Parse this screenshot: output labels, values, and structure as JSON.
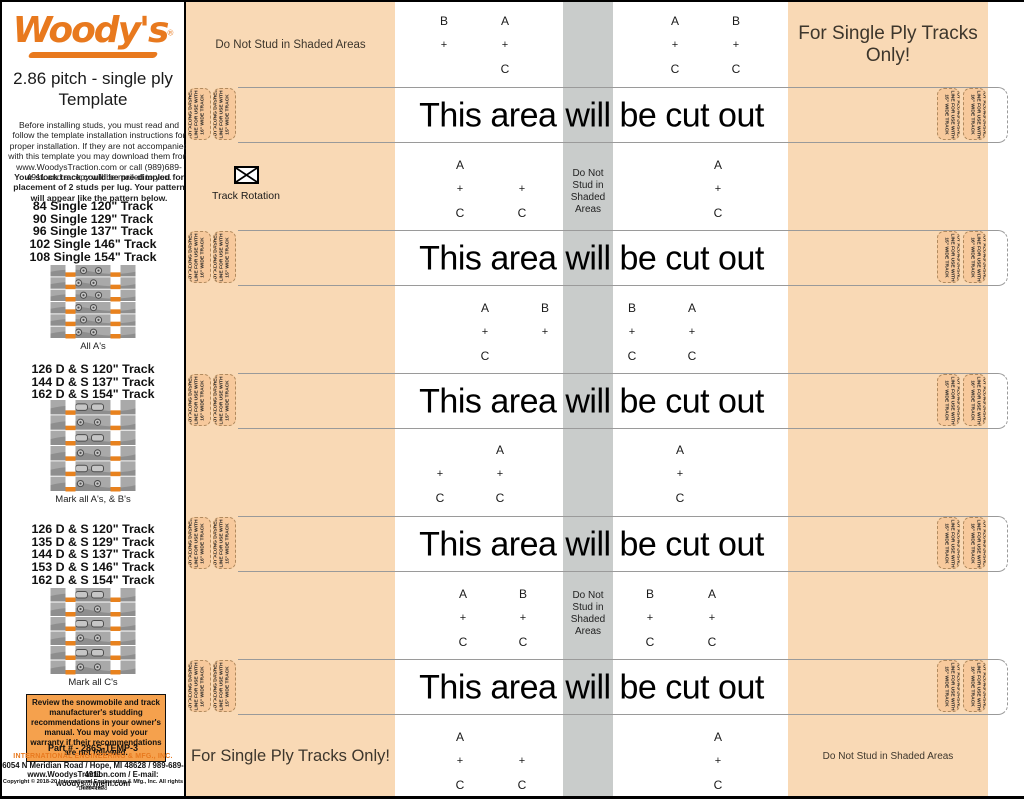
{
  "sidebar": {
    "logo": "Woody's",
    "logo_reg": "®",
    "title_line1": "2.86 pitch - single ply",
    "title_line2": "Template",
    "intro": "Before installing studs, you must read and follow the template installation instructions for proper installation. If they are not accompanied with this template you may download them from www.WoodysTraction.com or call (989)689-4911 and a copy will be mailed to you.",
    "dimple_note": "Your stock track could be pre-dimpled for placement of 2 studs per lug. Your pattern will appear like the pattern below.",
    "track_groups": [
      {
        "lines": [
          "84 Single 120\" Track",
          "90 Single 129\" Track",
          "96 Single 137\" Track",
          "102 Single 146\" Track",
          "108 Single 154\" Track"
        ],
        "caption": "All A's"
      },
      {
        "lines": [
          "126 D & S 120\" Track",
          "144 D & S 137\" Track",
          "162 D & S 154\" Track"
        ],
        "caption": "Mark all A's, & B's"
      },
      {
        "lines": [
          "126 D & S 120\" Track",
          "135 D & S 129\" Track",
          "144 D & S 137\" Track",
          "153 D & S 146\" Track",
          "162 D & S 154\" Track"
        ],
        "caption": "Mark all C's"
      }
    ],
    "warning": "Review the snowmobile and track manufacturer's studding recommendations in your owner's manual. You may void your warranty if their recommendations are not followed.",
    "footer": {
      "part": "Part # - 286S-TEMP-3",
      "company": "INTERNATIONAL ENGINEERING & MFG., INC.",
      "address": "6054 N Meridian Road / Hope, MI 48628 / 989-689-4911",
      "web_email": "www.WoodysTraction.com / E-mail: woodys@wiem.com",
      "copyright": "Copyright © 2018-20 International Engineering & Mfg., Inc. All rights reserved.",
      "doc": "Doc041828"
    }
  },
  "template": {
    "cut_band_label": "This area will be cut out",
    "do_not_stud_line": "Do Not Stud in Shaded Areas",
    "do_not_stud_stack": [
      "Do Not",
      "Stud in",
      "Shaded",
      "Areas"
    ],
    "single_ply_label": "For Single Ply Tracks Only!",
    "track_rotation_label": "Track Rotation",
    "tab15_lines": [
      "CUT ALONG DASHED",
      "LINE FOR USE WITH",
      "15\" WIDE TRACK"
    ],
    "tab16_lines": [
      "CUT ALONG DASHED",
      "LINE FOR USE WITH",
      "16\" WIDE TRACK"
    ],
    "bands_y": [
      85,
      228,
      371,
      514,
      657
    ],
    "shaded_text_rows_y": [
      166,
      588
    ],
    "marks": [
      {
        "x": 258,
        "y": 8,
        "top": "B",
        "plus": "+",
        "bottom": ""
      },
      {
        "x": 319,
        "y": 8,
        "top": "A",
        "plus": "+",
        "bottom": "C"
      },
      {
        "x": 489,
        "y": 8,
        "top": "A",
        "plus": "+",
        "bottom": "C"
      },
      {
        "x": 550,
        "y": 8,
        "top": "B",
        "plus": "+",
        "bottom": "C"
      },
      {
        "x": 274,
        "y": 152,
        "top": "A",
        "plus": "+",
        "bottom": "C"
      },
      {
        "x": 336,
        "y": 152,
        "top": "",
        "plus": "+",
        "bottom": "C"
      },
      {
        "x": 532,
        "y": 152,
        "top": "A",
        "plus": "+",
        "bottom": "C"
      },
      {
        "x": 299,
        "y": 295,
        "top": "A",
        "plus": "+",
        "bottom": "C"
      },
      {
        "x": 359,
        "y": 295,
        "top": "B",
        "plus": "+",
        "bottom": ""
      },
      {
        "x": 446,
        "y": 295,
        "top": "B",
        "plus": "+",
        "bottom": "C"
      },
      {
        "x": 506,
        "y": 295,
        "top": "A",
        "plus": "+",
        "bottom": "C"
      },
      {
        "x": 254,
        "y": 437,
        "top": "",
        "plus": "+",
        "bottom": "C"
      },
      {
        "x": 314,
        "y": 437,
        "top": "A",
        "plus": "+",
        "bottom": "C"
      },
      {
        "x": 494,
        "y": 437,
        "top": "A",
        "plus": "+",
        "bottom": "C"
      },
      {
        "x": 277,
        "y": 581,
        "top": "A",
        "plus": "+",
        "bottom": "C"
      },
      {
        "x": 337,
        "y": 581,
        "top": "B",
        "plus": "+",
        "bottom": "C"
      },
      {
        "x": 464,
        "y": 581,
        "top": "B",
        "plus": "+",
        "bottom": "C"
      },
      {
        "x": 526,
        "y": 581,
        "top": "A",
        "plus": "+",
        "bottom": "C"
      },
      {
        "x": 274,
        "y": 724,
        "top": "A",
        "plus": "+",
        "bottom": "C"
      },
      {
        "x": 336,
        "y": 724,
        "top": "",
        "plus": "+",
        "bottom": "C"
      },
      {
        "x": 532,
        "y": 724,
        "top": "A",
        "plus": "+",
        "bottom": "C"
      }
    ]
  },
  "colors": {
    "peach": "#f9d9b5",
    "tab_fill": "#f7c99c",
    "gray_strip": "#c9cccb",
    "woodys_orange": "#e8791e",
    "warning_bg": "#f5a14d"
  }
}
